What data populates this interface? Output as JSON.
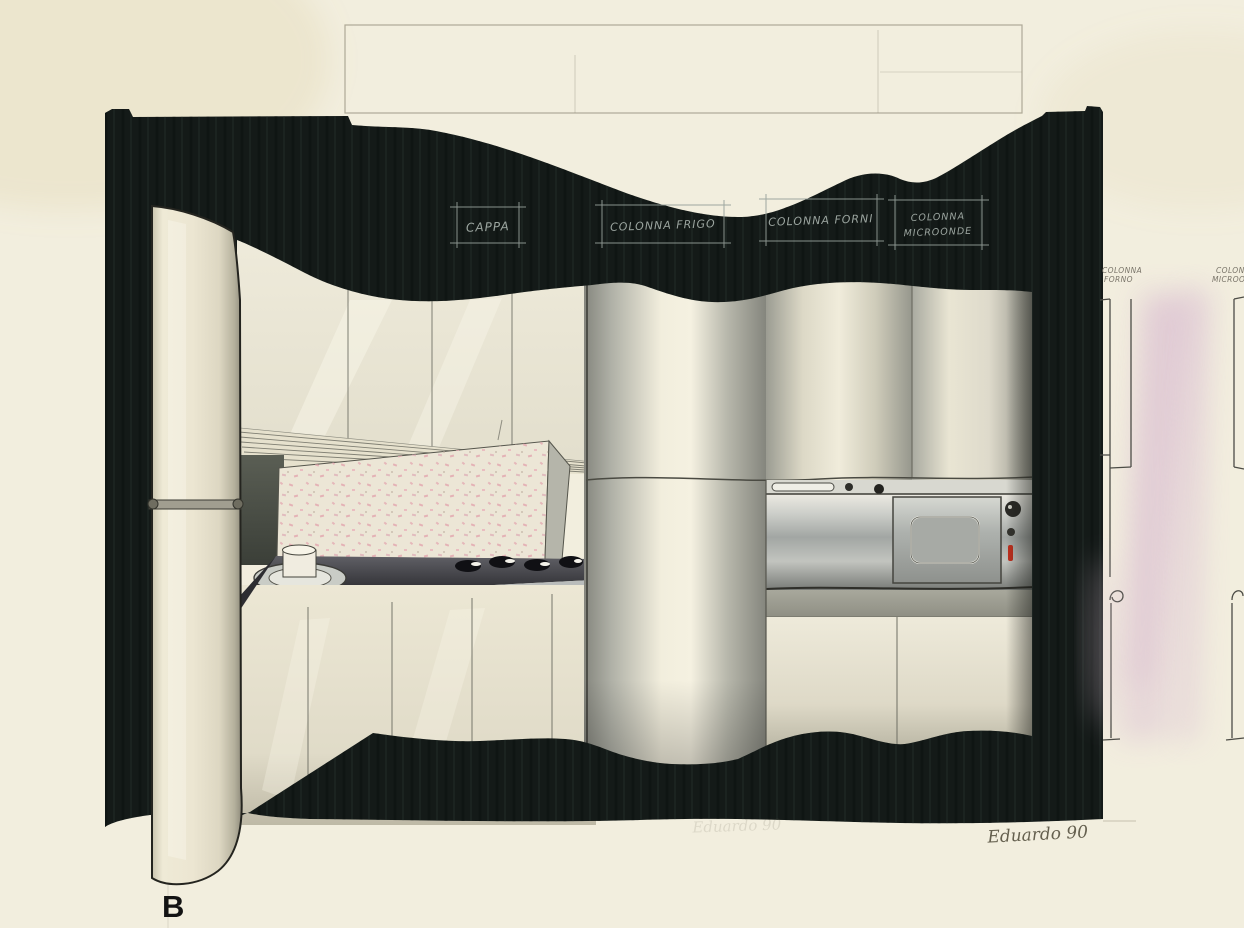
{
  "artwork": {
    "type": "hand-drawn kitchen interior design marker sketch",
    "figure_label": "B",
    "signature": "Eduardo 90",
    "ghost_signature": "Eduardo 90"
  },
  "callouts": {
    "cappa": "CAPPA",
    "colonna_frigo": "COLONNA FRIGO",
    "colonna_forni": "COLONNA FORNI",
    "colonna_microonde_l1": "COLONNA",
    "colonna_microonde_l2": "MICROONDE"
  },
  "side_sections": {
    "forno_l1": "COLONNA",
    "forno_l2": "FORNO",
    "micro_l1": "COLONNA",
    "micro_l2": "MICROONDE"
  },
  "colors": {
    "paper": "#f2eede",
    "ink_dark": "#141a18",
    "cream_cabinet": "#ece6d2",
    "steel_gray": "#a2a6a3",
    "pink_section": "#d9bcd2",
    "speckle_pink": "#e2a9b0",
    "indicator_red": "#c0301e",
    "callout_white": "#aab4ae"
  }
}
